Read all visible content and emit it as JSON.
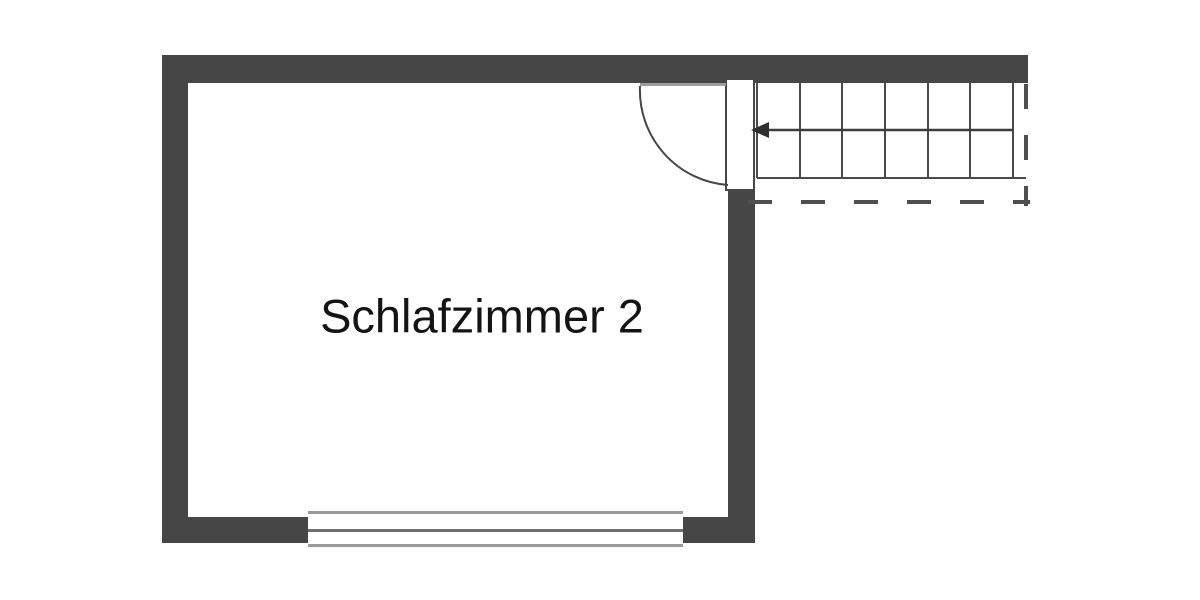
{
  "image": {
    "type": "floor-plan",
    "background": "#ffffff"
  },
  "floorplan": {
    "room": {
      "label": "Schlafzimmer 2"
    },
    "door": {
      "symbol": "single-swing-door",
      "swing_into": "room"
    },
    "stairs": {
      "symbol": "staircase",
      "tread_lines": 7,
      "walk_direction": "left-into-room",
      "boundary_style": "dashed"
    },
    "window": {
      "symbol": "double-line-window",
      "wall": "bottom"
    },
    "colors": {
      "wall": "#464646",
      "stair_line": "#4a4a4a",
      "walk_line": "#3d3d3d",
      "dash_line": "#4f4f4f",
      "door_closed_line": "#9c9c9c",
      "window_frame": "#9a9a9a",
      "window_mid": "#707070",
      "text": "#141414",
      "background": "#ffffff"
    }
  }
}
